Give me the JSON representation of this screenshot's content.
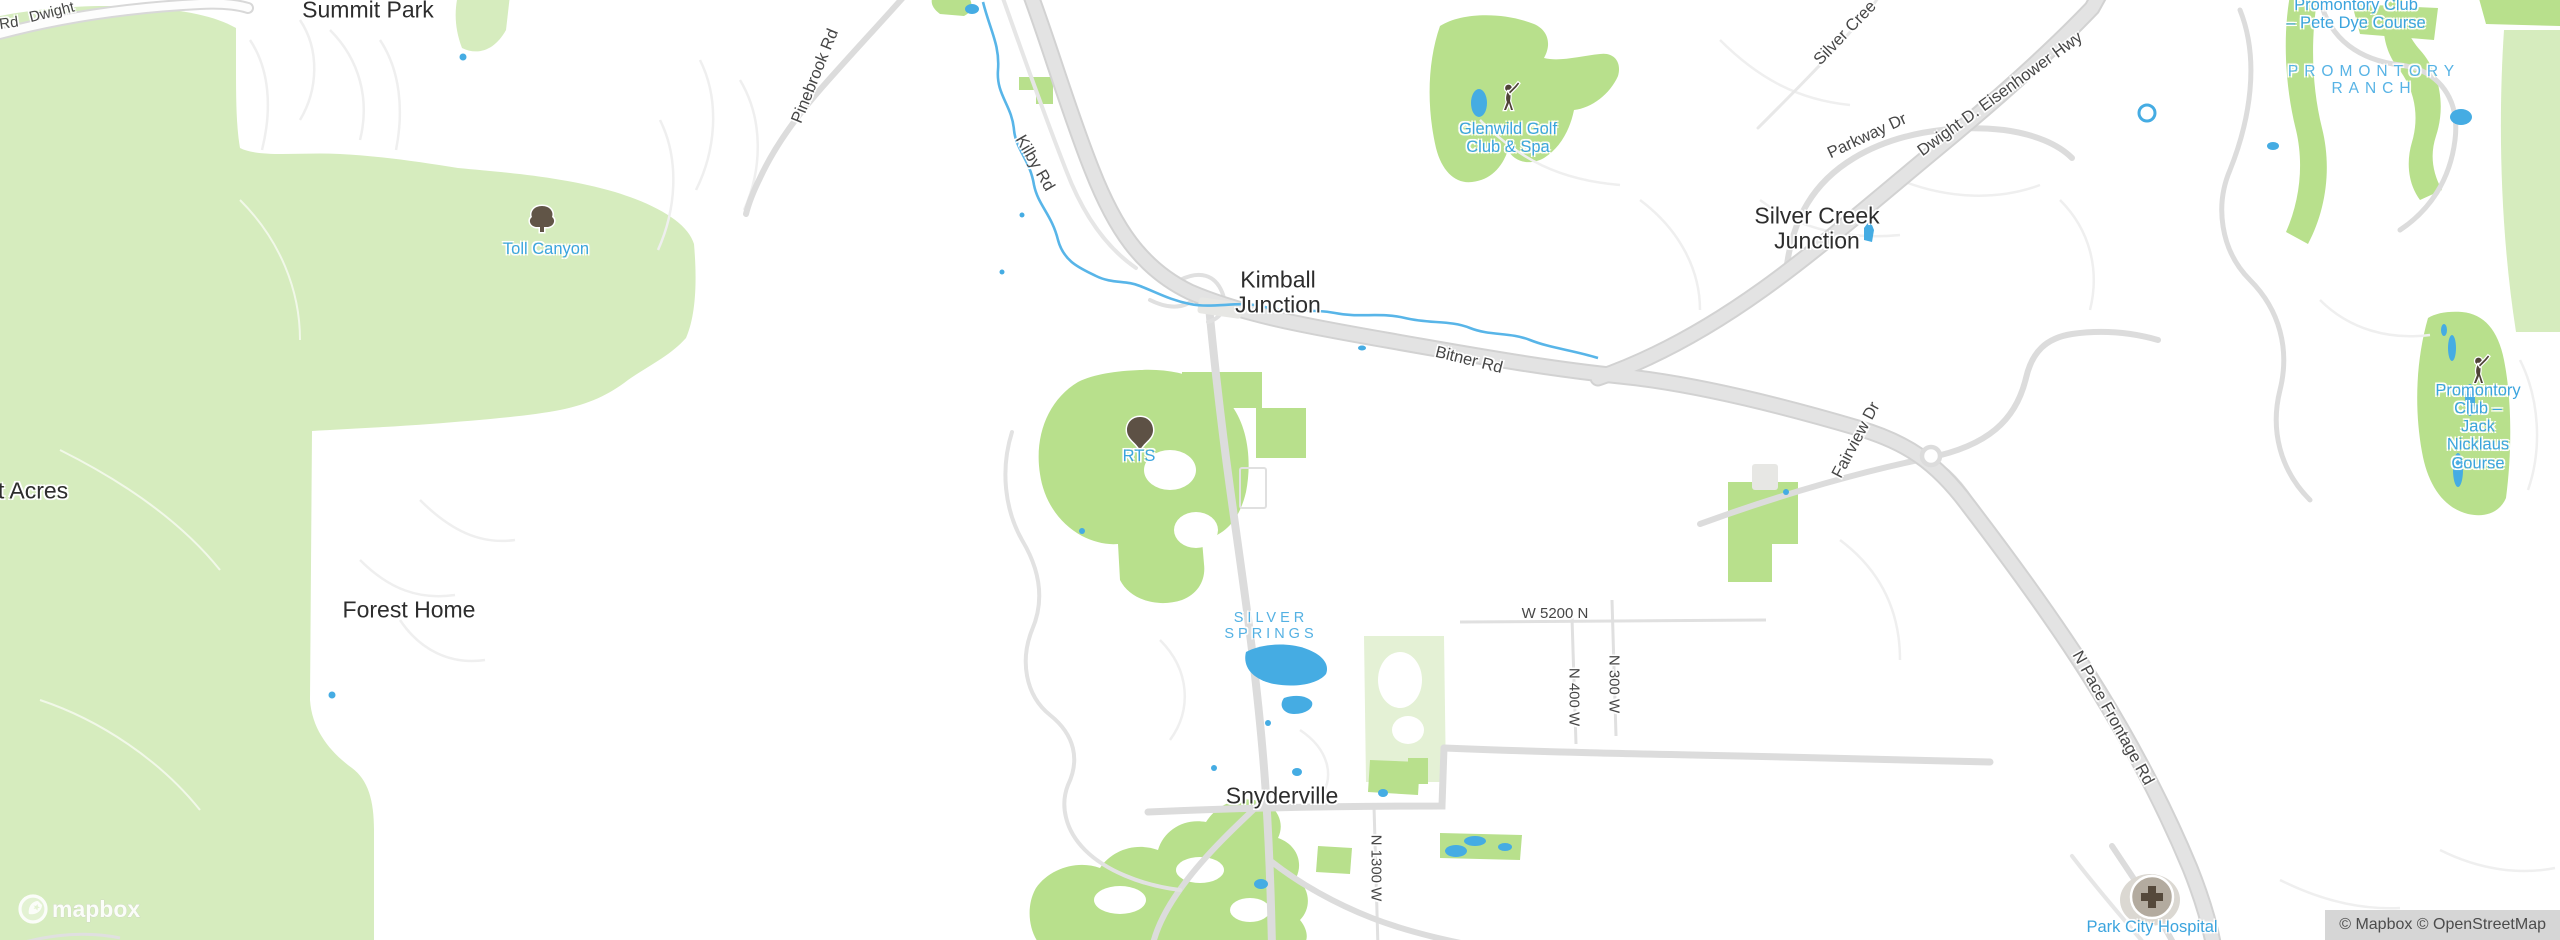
{
  "map_title": "Kimball Junction area street map",
  "labels": {
    "rd_partial": "Rd",
    "dwight_partial": "Dwight",
    "summit_park": "Summit Park",
    "pinebrook_rd": "Pinebrook Rd",
    "kilby_rd": "Kilby Rd",
    "toll_canyon": "Toll Canyon",
    "glenwild": "Glenwild Golf\nClub & Spa",
    "kimball_junction": "Kimball\nJunction",
    "bitner_rd": "Bitner Rd",
    "silver_creek_rd": "Silver Cree",
    "parkway_dr": "Parkway Dr",
    "eisenhower_hwy": "Dwight D. Eisenhower Hwy",
    "silver_creek_junction": "Silver Creek\nJunction",
    "promontory_pete": "Promontory Club\n– Pete Dye Course",
    "promontory_ranch": "PROMONTORY\nRANCH",
    "promontory_jack": "Promontory\nClub – Jack\nNicklaus Course",
    "rts": "RTS",
    "acres": "t Acres",
    "forest_home": "Forest Home",
    "silver_springs": "SILVER\nSPRINGS",
    "w_5200_n": "W 5200 N",
    "n_400_w": "N 400 W",
    "n_300_w": "N 300 W",
    "fairview_dr": "Fairview Dr",
    "n_pace_frontage_rd": "N Pace Frontage Rd",
    "snyderville": "Snyderville",
    "n_1300_w": "N 1300 W",
    "park_city_hospital": "Park City Hospital"
  },
  "icons": {
    "tree": "tree-icon",
    "park_marker": "park-marker-icon",
    "golfer": "golfer-icon",
    "hospital": "hospital-icon",
    "logo_pin": "mapbox-pin-icon"
  },
  "colors": {
    "land": "#ffffff",
    "forest_green": "#d6ecbe",
    "park_green": "#b8e08c",
    "pale_green": "#e4f1d5",
    "water": "#45ace3",
    "highway": "#e3e3e3",
    "medium_road": "#dcdcdc",
    "minor_road": "#efefef",
    "place_label": "#2d2d2d",
    "road_label": "#464646",
    "poi_label": "#3ba4de",
    "neighborhood_label": "#57b3e5",
    "attribution_bg": "#c6c6c6"
  },
  "attribution": "© Mapbox © OpenStreetMap",
  "logo": "mapbox"
}
